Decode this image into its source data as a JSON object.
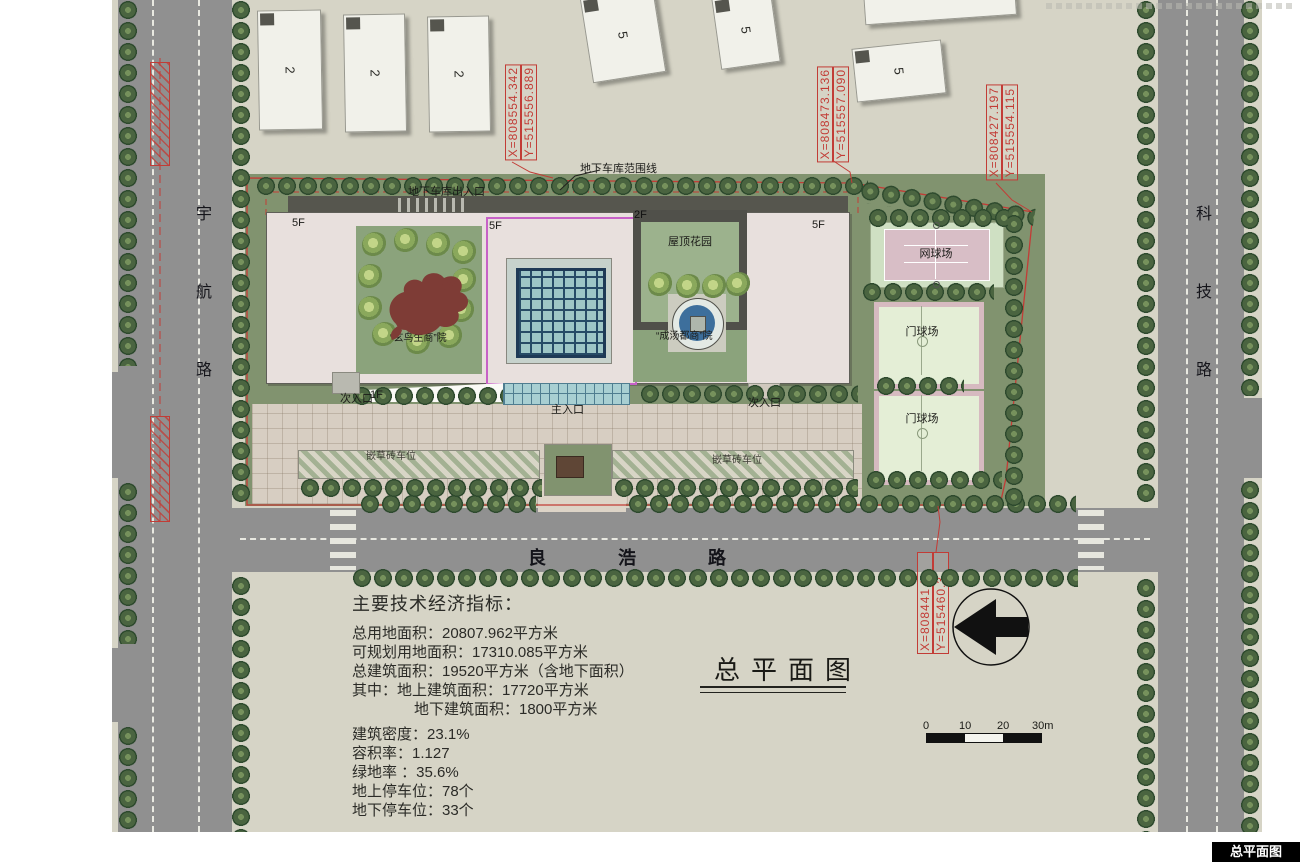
{
  "title_block": {
    "title": "总平面图",
    "corner_stamp": "总平面图"
  },
  "roads": {
    "left": [
      "宇",
      "航",
      "路"
    ],
    "right": [
      "科",
      "技",
      "路"
    ],
    "bottom": [
      "良",
      "浩",
      "路"
    ]
  },
  "coords": [
    {
      "x": "X=808554.342",
      "y": "Y=515556.889"
    },
    {
      "x": "X=808473.136",
      "y": "Y=515557.090"
    },
    {
      "x": "X=808427.197",
      "y": "Y=515554.115"
    },
    {
      "x": "X=808441.5",
      "y": "Y=515460.3"
    }
  ],
  "labels": {
    "garage_boundary": "地下车库范围线",
    "garage_entrance": "地下车库出入口",
    "roof_garden": "屋顶花园",
    "tennis_court": "网球场",
    "gateball_court": "门球场",
    "main_entrance": "主入口",
    "secondary_entrance": "次入口",
    "courtyard_west": "“玄鸟生商”院",
    "courtyard_east": "“成汤都商”院",
    "parking_strip": "嵌草砖车位",
    "floor_5f": "5F",
    "floor_2f": "2F",
    "floor_1f": "1F",
    "neighbor_block_2": "2",
    "neighbor_block_5": "5"
  },
  "indicators": {
    "heading": "主要技术经济指标：",
    "lines": [
      "总用地面积：20807.962平方米",
      "可规划用地面积：17310.085平方米",
      "总建筑面积：19520平方米（含地下面积）",
      "其中：地上建筑面积：17720平方米",
      "地下建筑面积：1800平方米",
      "建筑密度：23.1%",
      "容积率：1.127",
      "绿地率 ：35.6%",
      "地上停车位：78个",
      "地下停车位：33个"
    ]
  },
  "scale_bar": {
    "ticks": [
      "0",
      "10",
      "20",
      "30m"
    ]
  },
  "colors": {
    "red_line": "#c23c36",
    "magenta_outline": "#c761c7",
    "lawn": "#81936f",
    "road": "#909090",
    "building_roof": "#e8e0dd",
    "skylight_teal": "#9ec6c6",
    "paper": "#d6d4c6"
  }
}
